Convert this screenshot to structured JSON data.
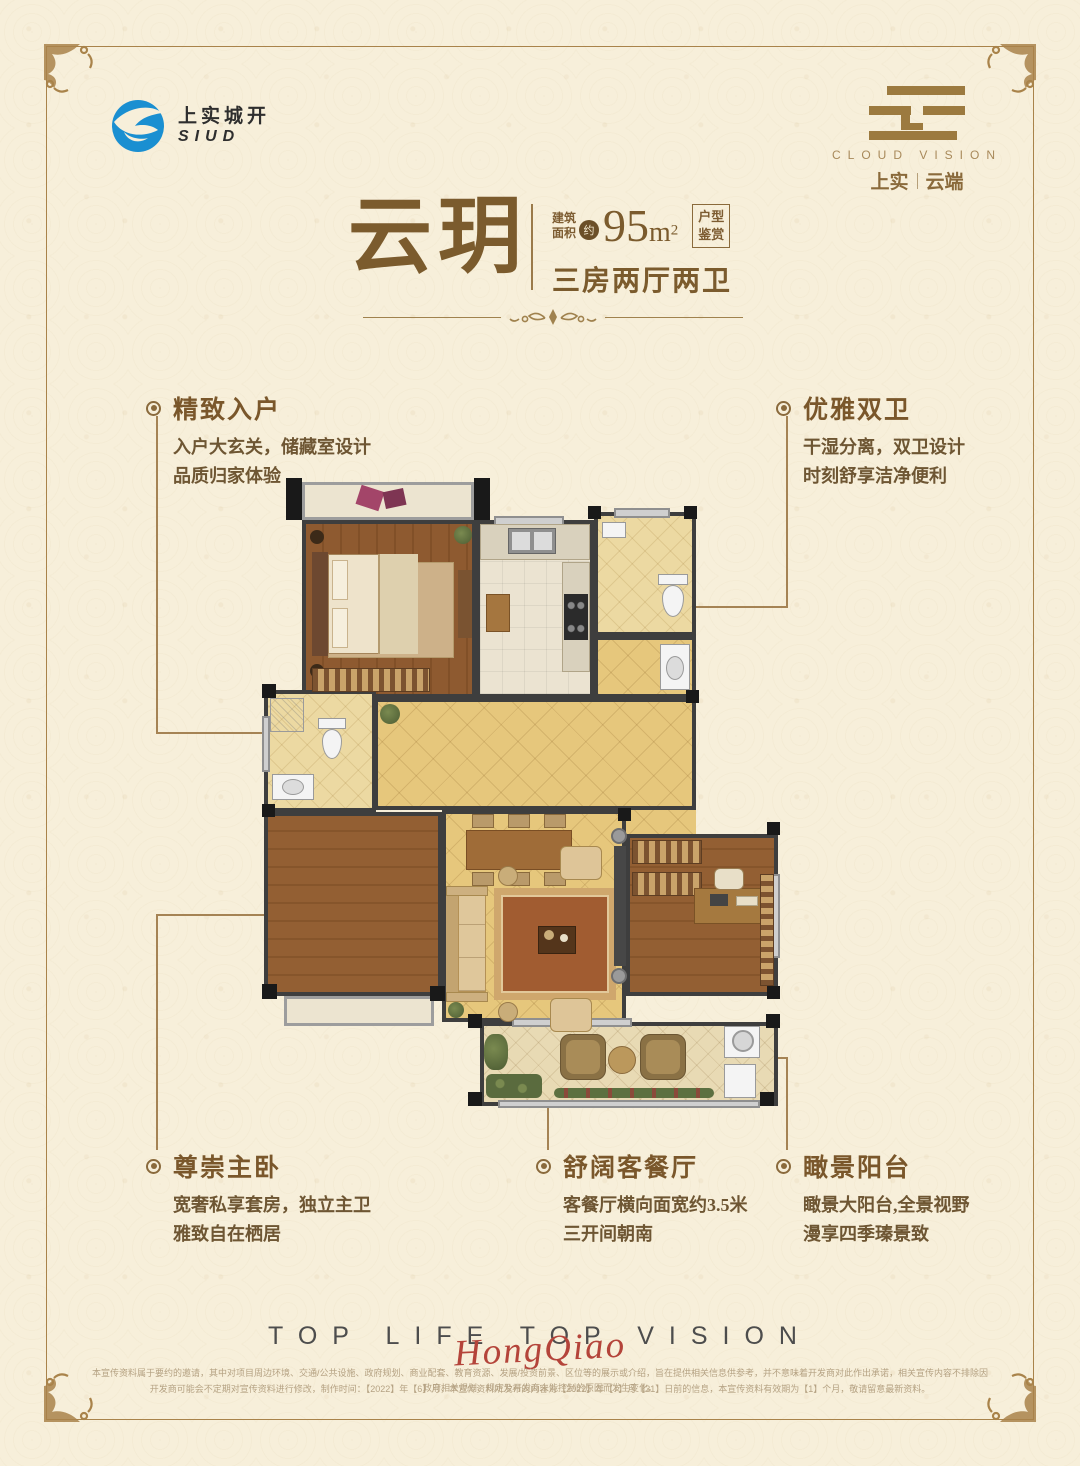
{
  "header": {
    "left_logo": {
      "cn": "上实城开",
      "en": "SIUD",
      "icon": "siud-swoosh-icon",
      "icon_color": "#1a8fd1"
    },
    "right_logo": {
      "mark": "cloud-bars-mark",
      "en": "CLOUD VISION",
      "cn_left": "上实",
      "cn_right": "云端"
    }
  },
  "title": {
    "name": "云玥",
    "area_label_line1": "建筑",
    "area_label_line2": "面积",
    "approx": "约",
    "area_num": "95",
    "area_unit": "m",
    "area_sup": "2",
    "badge_line1": "户型",
    "badge_line2": "鉴赏",
    "layout": "三房两厅两卫"
  },
  "callouts": [
    {
      "title": "精致入户",
      "lines": [
        "入户大玄关，储藏室设计",
        "品质归家体验"
      ]
    },
    {
      "title": "优雅双卫",
      "lines": [
        "干湿分离，双卫设计",
        "时刻舒享洁净便利"
      ]
    },
    {
      "title": "尊崇主卧",
      "lines": [
        "宽奢私享套房，独立主卫",
        "雅致自在栖居"
      ]
    },
    {
      "title": "舒阔客餐厅",
      "lines": [
        "客餐厅横向面宽约3.5米",
        "三开间朝南"
      ]
    },
    {
      "title": "瞰景阳台",
      "lines": [
        "瞰景大阳台,全景视野",
        "漫享四季瑧景致"
      ]
    }
  ],
  "footer": {
    "slogan": "TOP LIFE TOP VISION",
    "signature": "HongQiao"
  },
  "fine_print": {
    "line1": "本宣传资料属于要约的邀请，其中对项目周边环境、交通/公共设施、政府规划、商业配套、教育资源、发展/投资前景、区位等的展示或介绍，旨在提供相关信息供参考，并不意味着开发商对此作出承诺，相关宣传内容不排除因政府相关规划、规定及开发商未能控制的原因而发生变化。",
    "line2": "开发商可能会不定期对宣传资料进行修改，制作时间：【2022】年【6】月，本宣传资料所发布的内容为【2022】年【7】月【31】日前的信息，本宣传资料有效期为【1】个月，敬请留意最新资料。"
  },
  "colors": {
    "background": "#f7efda",
    "frame_gold": "#a9834a",
    "title_brown": "#7b5b2d",
    "body_brown": "#6e5633",
    "signature_red": "#b4443a",
    "logo_blue": "#1a8fd1",
    "wall_dark": "#3e3e3e",
    "floor_wood": "#8e5a30",
    "floor_tan": "#e6c77c"
  }
}
